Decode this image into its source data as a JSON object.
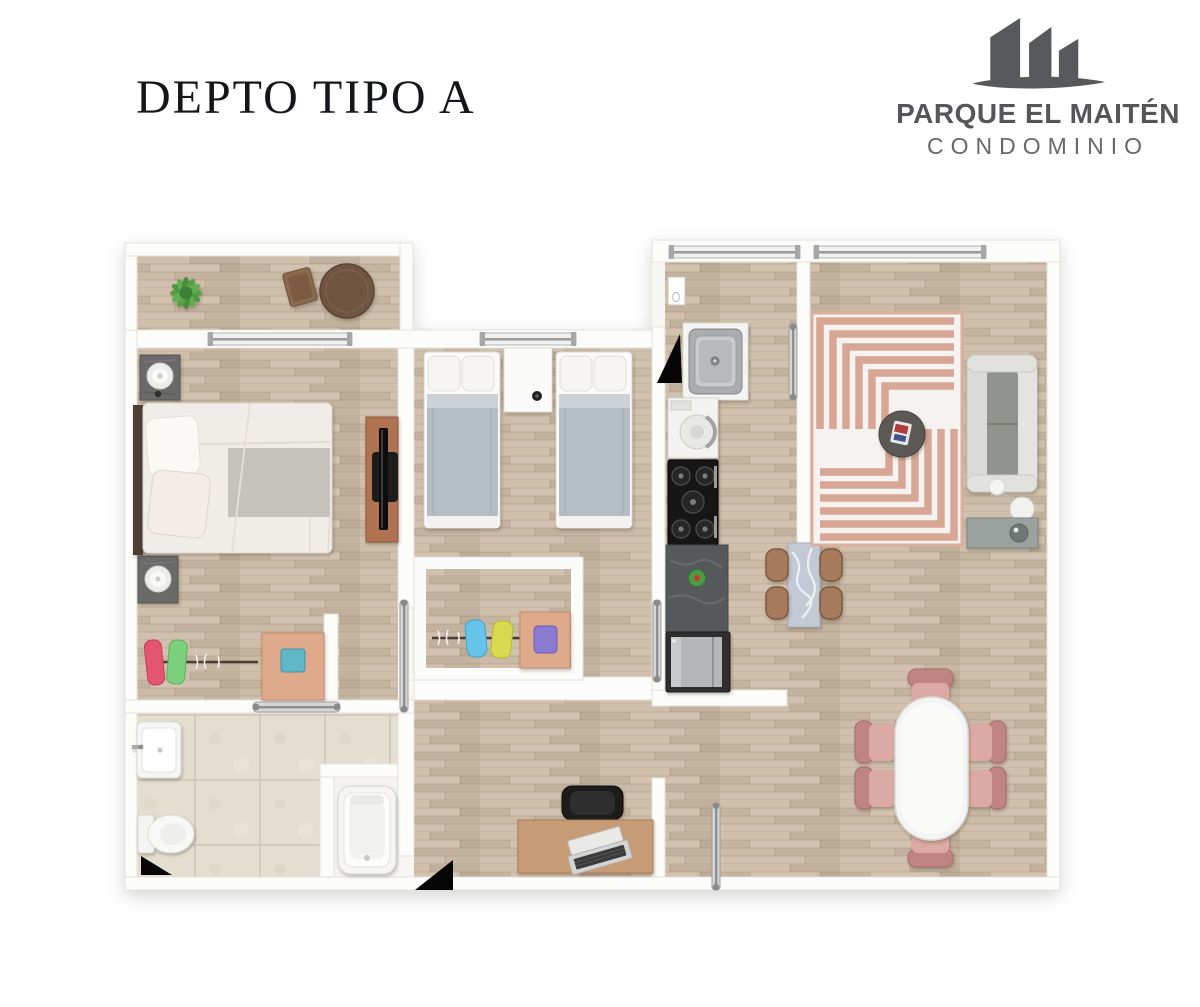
{
  "page": {
    "background": "#ffffff"
  },
  "header": {
    "title": "DEPTO TIPO A"
  },
  "logo": {
    "name": "PARQUE EL MAITÉN",
    "subtitle": "CONDOMINIO",
    "color": "#58595b",
    "icon": "buildings-logo-icon"
  },
  "floorplan": {
    "type": "apartment-floor-plan",
    "unit_label": "Depto Tipo A",
    "palette": {
      "wood_floor": "#c8b7a3",
      "wall_white": "#fcfcfb",
      "bathroom_tile": "#e4ded1",
      "rug_pink": "#d6a291",
      "sofa_gray": "#d8d8d4",
      "dining_chair_pink": "#dcaaa5",
      "counter_dark": "#56595c",
      "accent_teal": "#5fb7c8",
      "door_marker_black": "#050505",
      "chrome": "#cfcfcf"
    },
    "rooms": [
      {
        "name": "terrace",
        "items": [
          "green-plant",
          "round-wood-table",
          "wood-chair"
        ]
      },
      {
        "name": "master-bedroom",
        "items": [
          "double-bed",
          "nightstand-with-lamp",
          "nightstand-with-lamp",
          "tv-console",
          "closet-rail-with-clothes",
          "dresser-with-teal-box"
        ]
      },
      {
        "name": "bedroom-2",
        "items": [
          "single-bed",
          "single-bed",
          "white-nightstand",
          "closet-with-clothes",
          "dresser-with-purple-box"
        ]
      },
      {
        "name": "bathroom",
        "items": [
          "washbasin",
          "toilet",
          "bathtub",
          "sliding-door",
          "door-marker"
        ]
      },
      {
        "name": "hallway",
        "items": [
          "desk",
          "office-chair",
          "laptop"
        ]
      },
      {
        "name": "kitchen",
        "items": [
          "entry-door-leaf",
          "entry-door-marker",
          "steel-sink",
          "washing-machine",
          "gas-stove",
          "stone-counter",
          "fridge",
          "marble-breakfast-bar",
          "four-stools"
        ]
      },
      {
        "name": "living-room",
        "items": [
          "geometric-rug",
          "sofa",
          "round-ottoman",
          "floor-lamp",
          "side-table"
        ]
      },
      {
        "name": "dining-room",
        "items": [
          "oval-dining-table",
          "six-pink-chairs",
          "open-door-leaf"
        ]
      }
    ]
  }
}
